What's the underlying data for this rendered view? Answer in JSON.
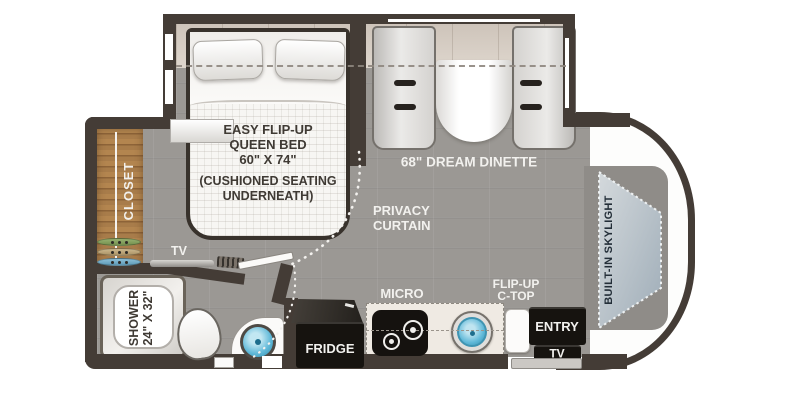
{
  "plan_type": "rv-floor-plan",
  "colors": {
    "wall": "#443c36",
    "floor": "#9b9894",
    "slide_wood": "#d5ccc3",
    "closet_wood": "#a87c4a",
    "sink_teal": "#5fb8d8",
    "fixture_black": "#16130f",
    "cap_white": "#fdfdfc",
    "skylight_gray": "#b0bac2",
    "label_white": "#f2f1ee",
    "label_dark": "#3f3a34"
  },
  "bedroom": {
    "bed_lines": [
      "EASY FLIP-UP",
      "QUEEN BED",
      "60\" X 74\""
    ],
    "bed_sub_lines": [
      "(CUSHIONED SEATING",
      "UNDERNEATH)"
    ],
    "closet_label": "CLOSET",
    "tv_label": "TV",
    "privacy_lines": [
      "PRIVACY",
      "CURTAIN"
    ]
  },
  "dinette": {
    "label": "68\" DREAM DINETTE"
  },
  "bathroom": {
    "shower_lines": [
      "SHOWER",
      "24\" X 32\""
    ]
  },
  "kitchen": {
    "fridge_label": "FRIDGE",
    "micro_label": "MICRO",
    "flipup_lines": [
      "FLIP-UP",
      "C-TOP"
    ]
  },
  "entry": {
    "entry_label": "ENTRY",
    "tv_label": "TV"
  },
  "front": {
    "skylight_label": "BUILT-IN SKYLIGHT"
  }
}
